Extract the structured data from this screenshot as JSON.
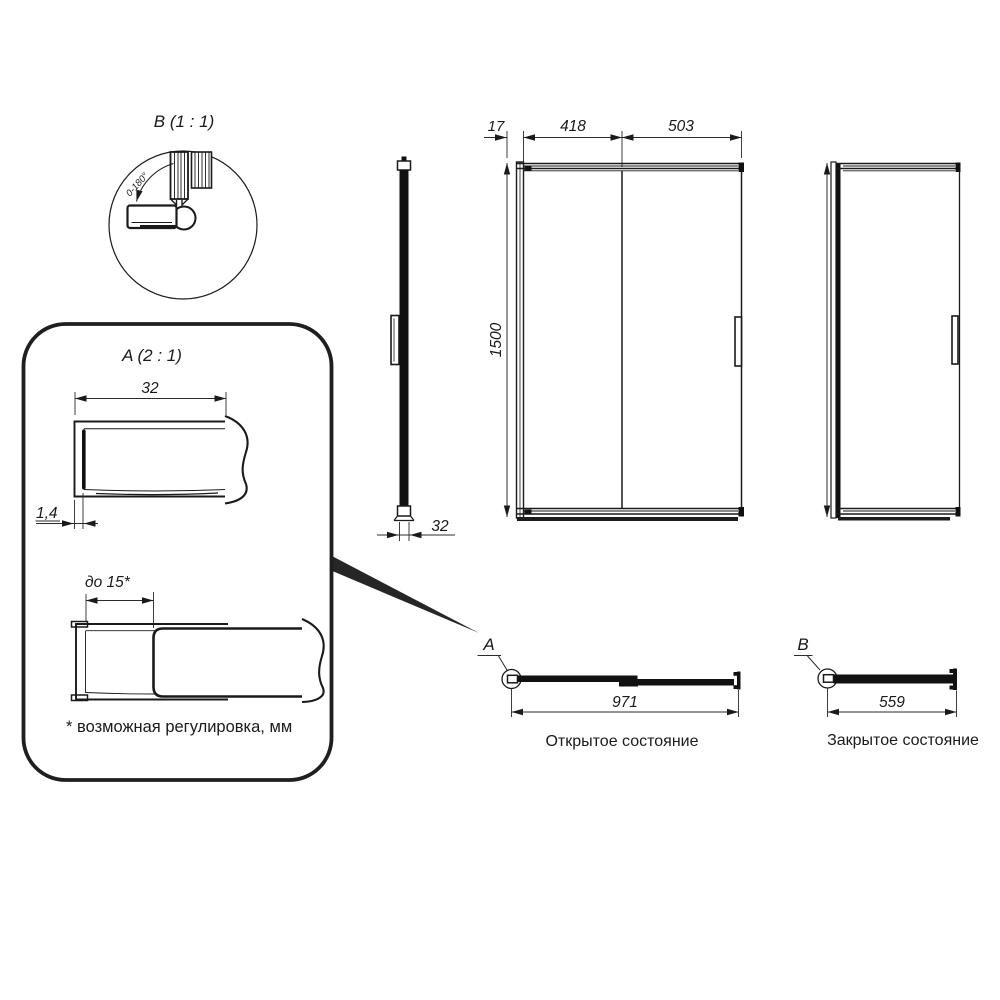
{
  "drawing": {
    "detail_b": {
      "title": "B (1 : 1)",
      "angle_label": "0-180°"
    },
    "detail_a": {
      "title": "A (2 : 1)",
      "dim_width": "32",
      "dim_thickness": "1,4",
      "dim_adjust": "до 15*",
      "footnote": "* возможная регулировка, мм"
    },
    "side_view": {
      "dim_depth": "32"
    },
    "front_view": {
      "dim_offset": "17",
      "dim_door": "418",
      "dim_fixed": "503",
      "dim_height": "1500"
    },
    "open_state": {
      "marker": "A",
      "dim_width": "971",
      "label": "Открытое состояние"
    },
    "closed_state": {
      "marker": "B",
      "dim_width": "559",
      "label": "Закрытое состояние"
    }
  },
  "colors": {
    "line": "#1a1a1a",
    "background": "#ffffff"
  }
}
